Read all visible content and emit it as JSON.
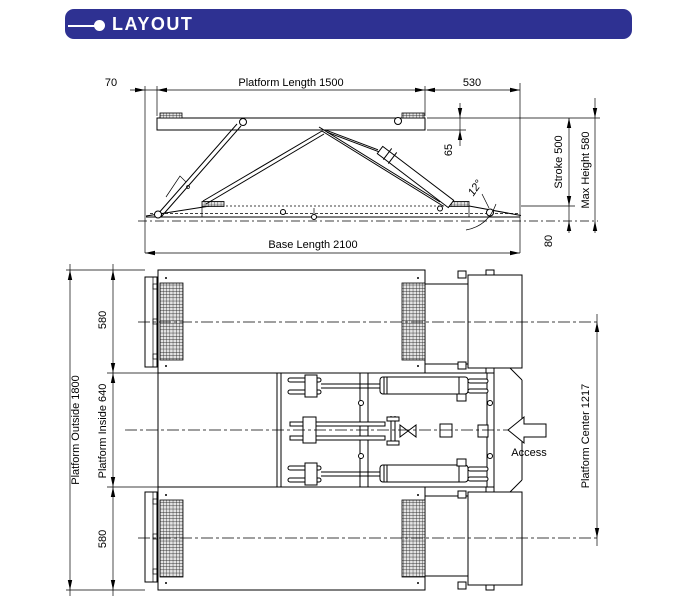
{
  "header": {
    "title": "LAYOUT",
    "bg_color": "#2e3192",
    "text_color": "#ffffff"
  },
  "side_view": {
    "dims": {
      "offset_left": "70",
      "platform_length": "Platform Length 1500",
      "right_overhang": "530",
      "platform_thickness": "65",
      "stroke": "Stroke 500",
      "max_height": "Max Height 580",
      "lowered_height": "80",
      "base_length": "Base Length 2100",
      "ramp_angle": "12°"
    }
  },
  "top_view": {
    "dims": {
      "platform_width_top": "580",
      "platform_outside": "Platform Outside 1800",
      "platform_inside": "Platform Inside 640",
      "platform_width_bottom": "580",
      "platform_center": "Platform Center 1217",
      "access": "Access"
    }
  }
}
